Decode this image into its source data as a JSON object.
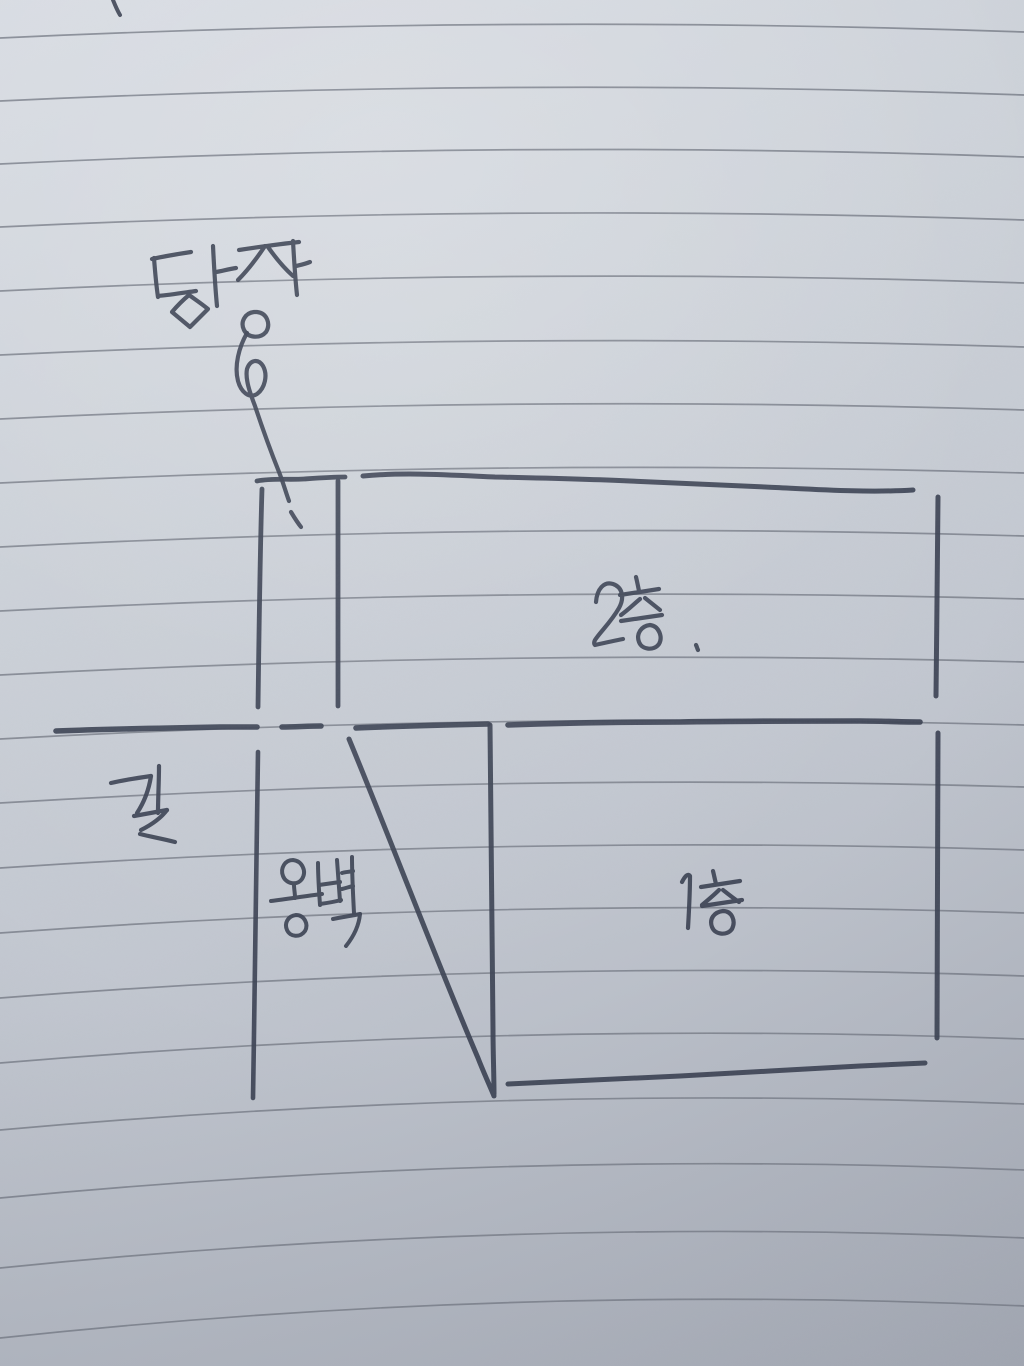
{
  "labels": {
    "fence": {
      "text": "담장"
    },
    "second_floor": {
      "text": "2층."
    },
    "road": {
      "text": "길"
    },
    "retaining_wall": {
      "text": "옹벽"
    },
    "first_floor": {
      "text": "1층"
    }
  },
  "colors": {
    "paper_top": "#d7dbe2",
    "paper_bottom": "#a8adb8",
    "ruled_line": "#767b86",
    "ink": "#3b4253"
  },
  "sketch": {
    "width": 1024,
    "height": 1366,
    "ink": "#3b4253",
    "ink_width": 4.5,
    "groups": [
      {
        "name": "ruled-lines",
        "color": "#767b86",
        "width": 1.7,
        "opacity": 0.8,
        "paths": [
          "M 0 38 Q 512 14 1024 32",
          "M 0 101 Q 512 77 1024 95",
          "M 0 164 Q 512 139 1024 157",
          "M 0 227 Q 512 203 1024 220",
          "M 0 291 Q 512 266 1024 283",
          "M 0 355 Q 512 331 1024 347",
          "M 0 419 Q 512 394 1024 410",
          "M 0 483 Q 512 458 1024 473",
          "M 0 547 Q 512 521 1024 536",
          "M 0 611 Q 512 585 1024 599",
          "M 0 675 Q 512 648 1024 662",
          "M 0 739 Q 512 711 1024 725",
          "M 0 803 Q 512 772 1024 787",
          "M 0 868 Q 512 834 1024 850",
          "M 0 933 Q 512 896 1024 913",
          "M 0 998 Q 512 958 1024 976",
          "M 0 1063 Q 512 1020 1024 1039",
          "M 0 1130 Q 512 1084 1024 1104",
          "M 0 1198 Q 512 1149 1024 1170",
          "M 0 1268 Q 512 1216 1024 1238",
          "M 0 1338 Q 512 1283 1024 1306"
        ]
      },
      {
        "name": "stray-top-mark",
        "width": 4,
        "paths": [
          "M 113 0 C 115 5 117 10 120 15"
        ]
      },
      {
        "name": "fence-post",
        "width": 4.8,
        "paths": [
          "M 257 481 C 272 478 288 480 304 479 C 318 478 331 477 345 477",
          "M 262 489 C 260 552 259 630 258 707",
          "M 338 481 C 338 556 338 632 338 706"
        ]
      },
      {
        "name": "second-floor-outline",
        "width": 5,
        "paths": [
          "M 363 476 C 405 472 450 475 495 477 C 540 478 585 479 630 481 C 675 483 720 485 765 487 C 810 489 865 493 913 490",
          "M 938 497 C 937 560 937 630 936 696"
        ]
      },
      {
        "name": "ground-line",
        "width": 5.6,
        "paths": [
          "M 56 731 C 108 729 164 728 220 727 C 233 727 245 727 257 727",
          "M 282 727 C 295 727 308 726 321 726",
          "M 356 728 C 400 726 444 725 488 724",
          "M 508 725 C 560 723 620 722 680 722 C 740 721 800 721 860 721 C 882 721 902 722 920 722"
        ]
      },
      {
        "name": "first-floor-outline",
        "width": 5,
        "paths": [
          "M 490 725 C 491 815 492 940 493 1030 C 493 1052 494 1075 494 1094",
          "M 349 739 C 390 838 436 960 478 1058 C 483 1071 489 1084 494 1096",
          "M 938 733 C 938 830 937 940 937 1038",
          "M 508 1084 C 560 1082 620 1079 680 1076 C 740 1073 800 1069 860 1066 C 883 1065 905 1064 925 1063"
        ]
      },
      {
        "name": "retaining-wall-face-line",
        "width": 4.6,
        "paths": [
          "M 258 752 C 256 860 255 980 253 1098"
        ]
      },
      {
        "name": "fence-arrow",
        "width": 4.2,
        "paths": [
          "M 247 333 C 239 347 234 366 238 381 C 241 392 249 399 257 394 C 265 388 268 375 263 366 C 258 358 250 360 247 369 C 245 379 250 393 255 406 C 262 427 271 452 279 472 C 283 482 286 493 289 501",
          "M 291 512 C 294 517 297 522 301 527"
        ]
      },
      {
        "name": "fence-label-handwriting",
        "label": "담장",
        "width": 4.2,
        "paths": [
          "M 191 252 C 178 254 165 256 152 259",
          "M 154 258 C 155 271 156 284 158 297",
          "M 158 296 C 170 295 182 293 196 291",
          "M 213 246 C 214 266 215 286 217 306",
          "M 216 272 C 222 271 229 269 236 268",
          "M 189 295 C 183 300 177 306 172 312 C 178 317 184 322 190 327 C 196 321 202 315 208 309 C 202 304 196 300 189 295 Z",
          "M 239 250 C 259 247 279 244 299 242",
          "M 265 246 C 257 258 248 270 238 280",
          "M 268 247 C 275 257 283 267 293 276",
          "M 293 241 C 294 259 295 277 297 295",
          "M 296 266 C 300 265 305 264 310 262",
          "M 254 312 C 245 313 240 322 244 330 C 248 338 260 339 266 332 C 271 324 267 313 257 312 C 256 312 255 312 254 312 Z"
        ]
      },
      {
        "name": "second-floor-label-handwriting",
        "label": "2층.",
        "width": 4.2,
        "paths": [
          "M 596 602 C 597 589 604 581 613 584 C 622 587 625 597 619 608 C 611 622 601 631 595 640 C 594 642 594 644 595 645 C 604 643 613 641 623 639",
          "M 636 577 C 637 581 638 586 639 591",
          "M 620 595 C 633 593 646 591 659 589",
          "M 640 599 C 634 604 628 610 621 615",
          "M 645 598 C 650 602 655 606 660 610",
          "M 621 621 C 635 619 648 617 662 615",
          "M 650 625 C 641 626 636 634 639 642 C 642 650 654 651 659 644 C 663 637 659 626 650 625 Z",
          "M 696 645 C 697 647 697 648 698 650"
        ]
      },
      {
        "name": "road-label-handwriting",
        "label": "길",
        "width": 4.2,
        "paths": [
          "M 111 783 C 124 780 137 778 151 776",
          "M 151 776 C 149 789 145 801 137 813",
          "M 159 766 C 159 782 158 797 158 813",
          "M 134 816 C 145 814 156 812 167 810",
          "M 167 810 C 161 818 151 825 141 830",
          "M 140 834 C 152 837 164 839 175 842"
        ]
      },
      {
        "name": "retaining-wall-label-handwriting",
        "label": "옹벽",
        "width": 4,
        "paths": [
          "M 293 860 C 285 860 280 868 283 876 C 286 884 297 886 302 879 C 307 871 302 861 293 860 Z",
          "M 294 885 C 294 889 295 893 295 898",
          "M 271 901 C 288 899 305 896 322 894",
          "M 296 915 C 288 916 284 923 287 930 C 290 937 300 938 305 931 C 309 924 304 915 296 915 Z",
          "M 318 863 C 318 877 319 891 320 905",
          "M 337 860 C 338 874 339 887 340 901",
          "M 319 885 C 326 884 333 883 340 882",
          "M 320 904 C 327 903 334 902 341 900",
          "M 352 857 C 352 876 353 894 354 913",
          "M 342 873 C 345 872 349 872 353 871",
          "M 342 889 C 346 888 349 887 353 886",
          "M 333 919 C 342 917 351 916 360 914",
          "M 360 914 C 359 925 354 936 346 946"
        ]
      },
      {
        "name": "first-floor-label-handwriting",
        "label": "1층",
        "width": 4.2,
        "paths": [
          "M 682 882 C 685 876 688 873 690 876 C 690 893 689 911 688 928",
          "M 713 871 C 714 875 715 880 716 884",
          "M 701 887 C 714 885 727 883 740 881",
          "M 719 890 C 714 895 708 900 702 905",
          "M 723 890 C 728 894 733 898 739 902",
          "M 702 906 C 715 904 729 902 742 900",
          "M 723 911 C 714 912 709 919 712 927 C 715 935 727 936 732 929 C 736 921 732 911 723 911 Z"
        ]
      }
    ]
  }
}
